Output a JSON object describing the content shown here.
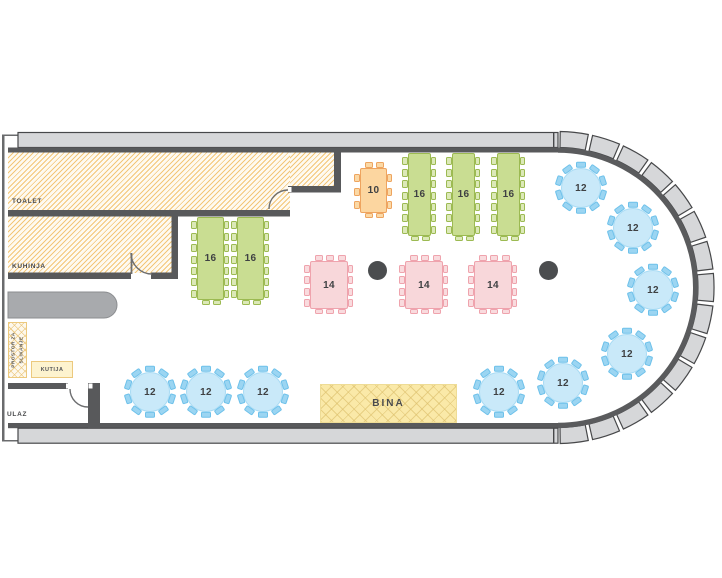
{
  "rooms": {
    "toalet": {
      "label": "TOALET"
    },
    "kuhinja": {
      "label": "KUHINJA"
    },
    "ulaz": {
      "label": "ULAZ"
    },
    "prostor": {
      "label_line1": "PROSTOR ZA",
      "label_line2": "SLIKANJE"
    },
    "kutija": {
      "label": "KUTIJA"
    },
    "bina": {
      "label": "BINA"
    }
  },
  "tables": [
    {
      "id": "long-16-a",
      "type": "rect",
      "color": "green",
      "label": "16",
      "x": 197,
      "y": 217,
      "w": 27,
      "h": 83,
      "chairs": {
        "left": 7,
        "right": 7,
        "top": 0,
        "bottom": 2
      }
    },
    {
      "id": "long-16-b",
      "type": "rect",
      "color": "green",
      "label": "16",
      "x": 237,
      "y": 217,
      "w": 27,
      "h": 83,
      "chairs": {
        "left": 7,
        "right": 7,
        "top": 0,
        "bottom": 2
      }
    },
    {
      "id": "long-16-c",
      "type": "rect",
      "color": "green",
      "label": "16",
      "x": 408,
      "y": 153,
      "w": 23,
      "h": 83,
      "chairs": {
        "left": 7,
        "right": 7,
        "top": 0,
        "bottom": 2
      }
    },
    {
      "id": "long-16-d",
      "type": "rect",
      "color": "green",
      "label": "16",
      "x": 452,
      "y": 153,
      "w": 23,
      "h": 83,
      "chairs": {
        "left": 7,
        "right": 7,
        "top": 0,
        "bottom": 2
      }
    },
    {
      "id": "long-16-e",
      "type": "rect",
      "color": "green",
      "label": "16",
      "x": 497,
      "y": 153,
      "w": 23,
      "h": 83,
      "chairs": {
        "left": 7,
        "right": 7,
        "top": 0,
        "bottom": 2
      }
    },
    {
      "id": "head-10",
      "type": "rect",
      "color": "orange",
      "label": "10",
      "x": 360,
      "y": 168,
      "w": 27,
      "h": 45,
      "chairs": {
        "left": 3,
        "right": 3,
        "top": 2,
        "bottom": 2
      }
    },
    {
      "id": "square-14-a",
      "type": "rect",
      "color": "pink",
      "label": "14",
      "x": 310,
      "y": 261,
      "w": 38,
      "h": 48,
      "chairs": {
        "left": 4,
        "right": 4,
        "top": 3,
        "bottom": 3
      }
    },
    {
      "id": "square-14-b",
      "type": "rect",
      "color": "pink",
      "label": "14",
      "x": 405,
      "y": 261,
      "w": 38,
      "h": 48,
      "chairs": {
        "left": 4,
        "right": 4,
        "top": 3,
        "bottom": 3
      }
    },
    {
      "id": "square-14-c",
      "type": "rect",
      "color": "pink",
      "label": "14",
      "x": 474,
      "y": 261,
      "w": 38,
      "h": 48,
      "chairs": {
        "left": 4,
        "right": 4,
        "top": 3,
        "bottom": 3
      }
    },
    {
      "id": "round-12-a",
      "type": "round",
      "color": "blue",
      "label": "12",
      "cx": 150,
      "cy": 392,
      "d": 40,
      "chairs": 10
    },
    {
      "id": "round-12-b",
      "type": "round",
      "color": "blue",
      "label": "12",
      "cx": 206,
      "cy": 392,
      "d": 40,
      "chairs": 10
    },
    {
      "id": "round-12-c",
      "type": "round",
      "color": "blue",
      "label": "12",
      "cx": 263,
      "cy": 392,
      "d": 40,
      "chairs": 10
    },
    {
      "id": "round-12-d",
      "type": "round",
      "color": "blue",
      "label": "12",
      "cx": 499,
      "cy": 392,
      "d": 40,
      "chairs": 10
    },
    {
      "id": "round-12-e",
      "type": "round",
      "color": "blue",
      "label": "12",
      "cx": 563,
      "cy": 383,
      "d": 40,
      "chairs": 10
    },
    {
      "id": "round-12-f",
      "type": "round",
      "color": "blue",
      "label": "12",
      "cx": 627,
      "cy": 354,
      "d": 40,
      "chairs": 10
    },
    {
      "id": "round-12-g",
      "type": "round",
      "color": "blue",
      "label": "12",
      "cx": 653,
      "cy": 290,
      "d": 40,
      "chairs": 10
    },
    {
      "id": "round-12-h",
      "type": "round",
      "color": "blue",
      "label": "12",
      "cx": 633,
      "cy": 228,
      "d": 40,
      "chairs": 10
    },
    {
      "id": "round-12-i",
      "type": "round",
      "color": "blue",
      "label": "12",
      "cx": 581,
      "cy": 188,
      "d": 40,
      "chairs": 10
    }
  ],
  "pillars": [
    {
      "cx": 377,
      "cy": 270,
      "r": 9.5
    },
    {
      "cx": 548,
      "cy": 270,
      "r": 9.5
    }
  ],
  "colors": {
    "wall_dark": "#58595b",
    "wall_light": "#d6d7d9",
    "wall_outline": "#47484a",
    "door_stroke": "#6d6e70",
    "hatch_line": "#f3c678",
    "hatch_bg": "#fefaf1",
    "green_fill": "#c9dd92",
    "green_border": "#9cba52",
    "green_chair": "#dce9b8",
    "orange_fill": "#fcd6a0",
    "orange_border": "#eea45f",
    "orange_chair": "#fbd9a6",
    "pink_fill": "#f8d7da",
    "pink_border": "#efa3ad",
    "pink_chair": "#f9dbde",
    "blue_fill": "#c9e9f9",
    "blue_edge": "#a8dbf4",
    "blue_chair": "#9bd5f2",
    "blue_chair_border": "#6ec1ea",
    "bina_fill": "#fae9a8",
    "bar_fill": "#a8aaad",
    "bar_border": "#8b8d90",
    "pillar": "#4b4d4f",
    "label": "#48494b"
  }
}
